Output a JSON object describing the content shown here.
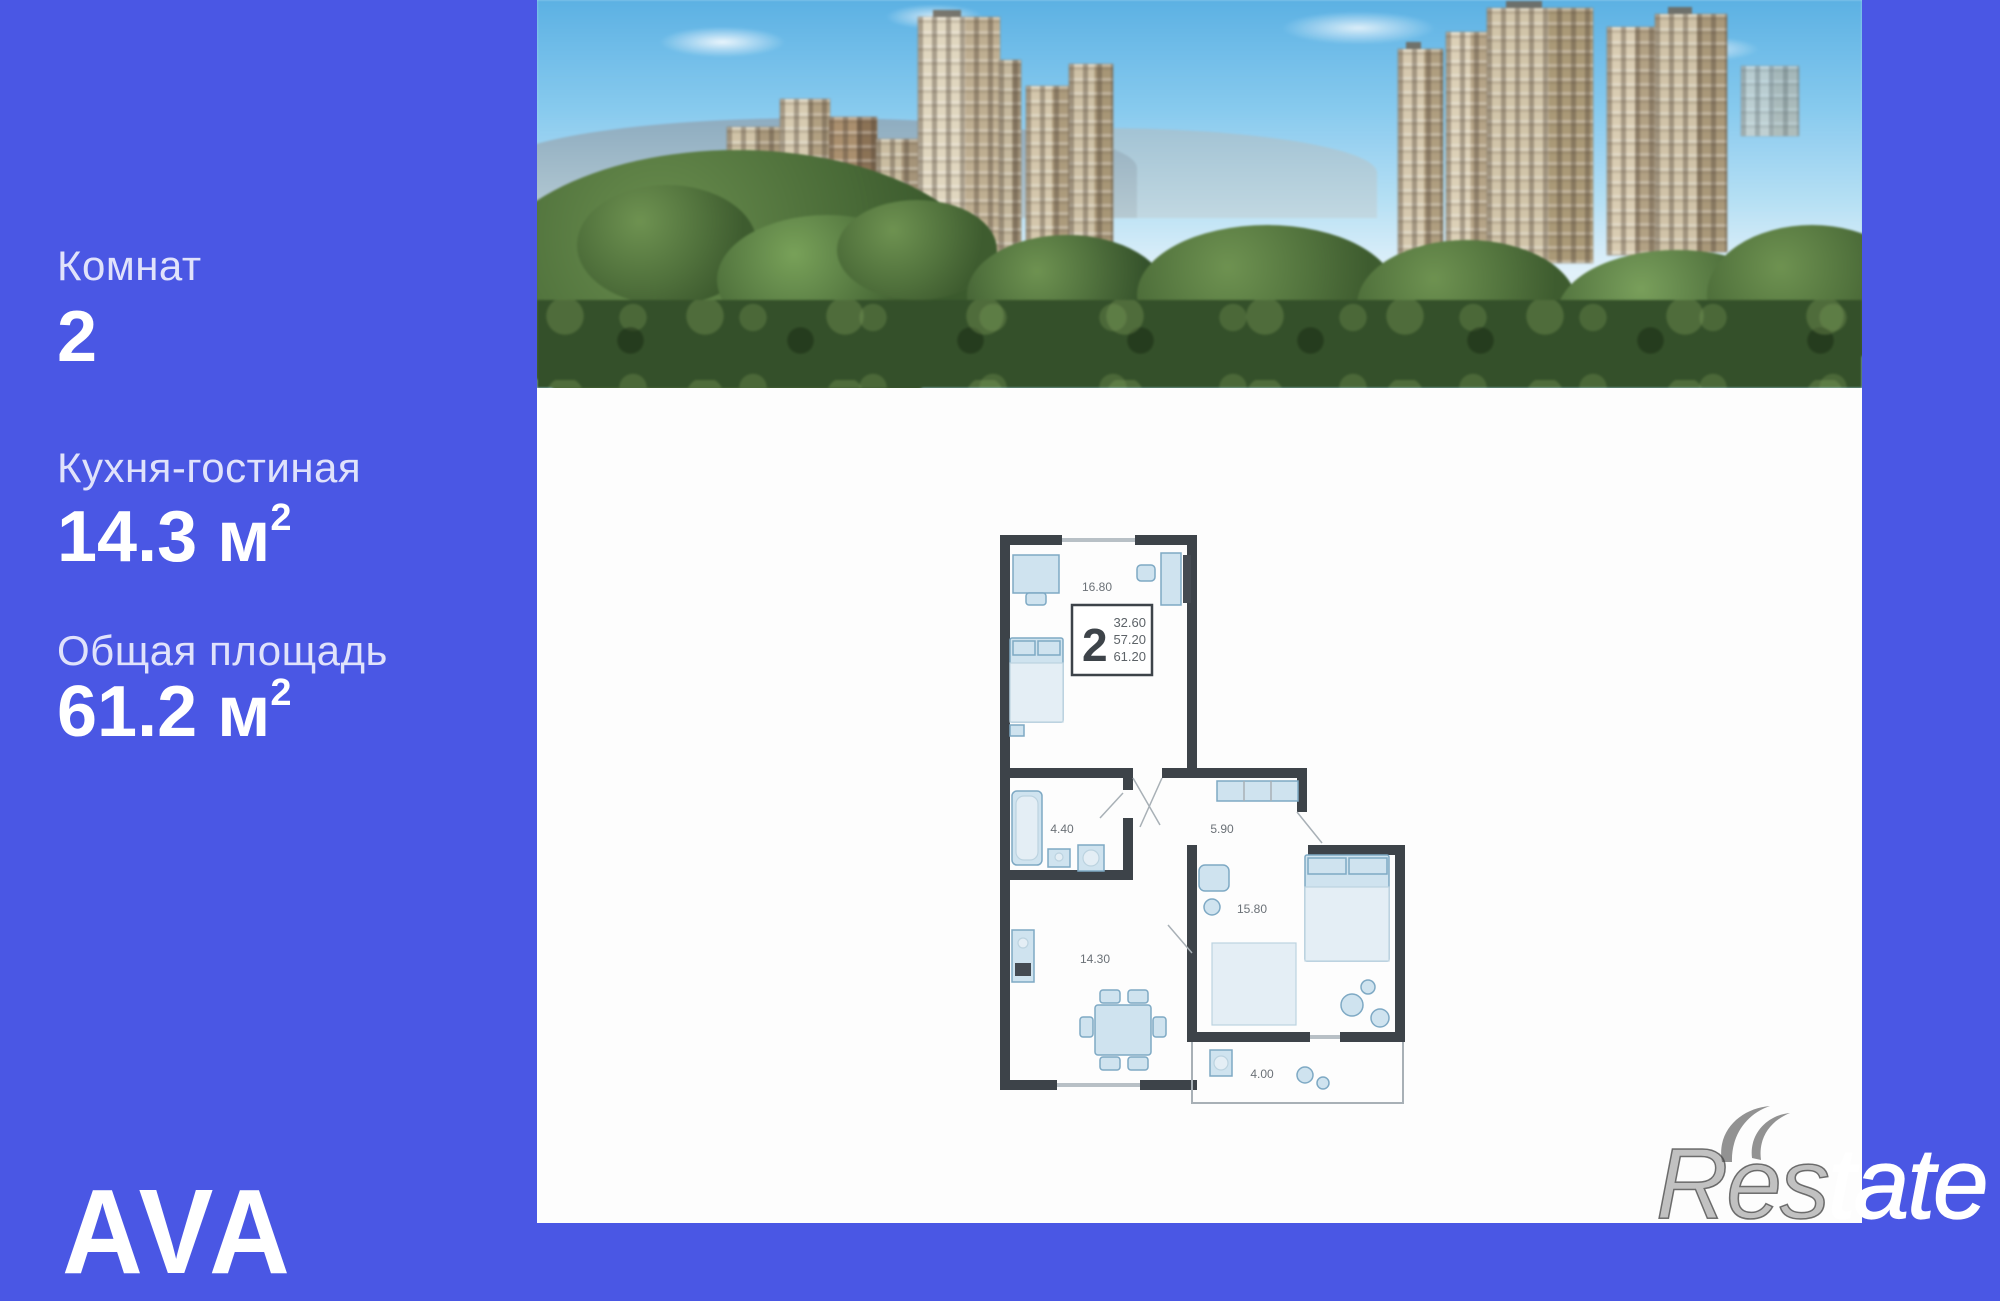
{
  "theme": {
    "accent_blue": "#4a57e4",
    "panel_white": "#fdfdfd",
    "wall_color": "#3d4349",
    "furniture_fill": "#cfe3ef"
  },
  "sidebar": {
    "stats": [
      {
        "label": "Комнат",
        "value": "2",
        "unit_base": "",
        "unit_sup": ""
      },
      {
        "label": "Кухня-гостиная",
        "value": "14.3",
        "unit_base": "м",
        "unit_sup": "2"
      },
      {
        "label": "Общая площадь",
        "value": "61.2",
        "unit_base": "м",
        "unit_sup": "2"
      }
    ],
    "logo": "AVA"
  },
  "floor_plan": {
    "summary": {
      "rooms": "2",
      "living_area": "32.60",
      "area_no_balcony": "57.20",
      "total_area": "61.20"
    },
    "rooms": [
      {
        "name": "bedroom-1",
        "area": "16.80"
      },
      {
        "name": "bathroom",
        "area": "4.40"
      },
      {
        "name": "hallway",
        "area": "5.90"
      },
      {
        "name": "bedroom-2",
        "area": "15.80"
      },
      {
        "name": "kitchen-living",
        "area": "14.30"
      },
      {
        "name": "loggia",
        "area": "4.00"
      }
    ]
  },
  "watermark": {
    "left": "Res",
    "right": "tate"
  }
}
